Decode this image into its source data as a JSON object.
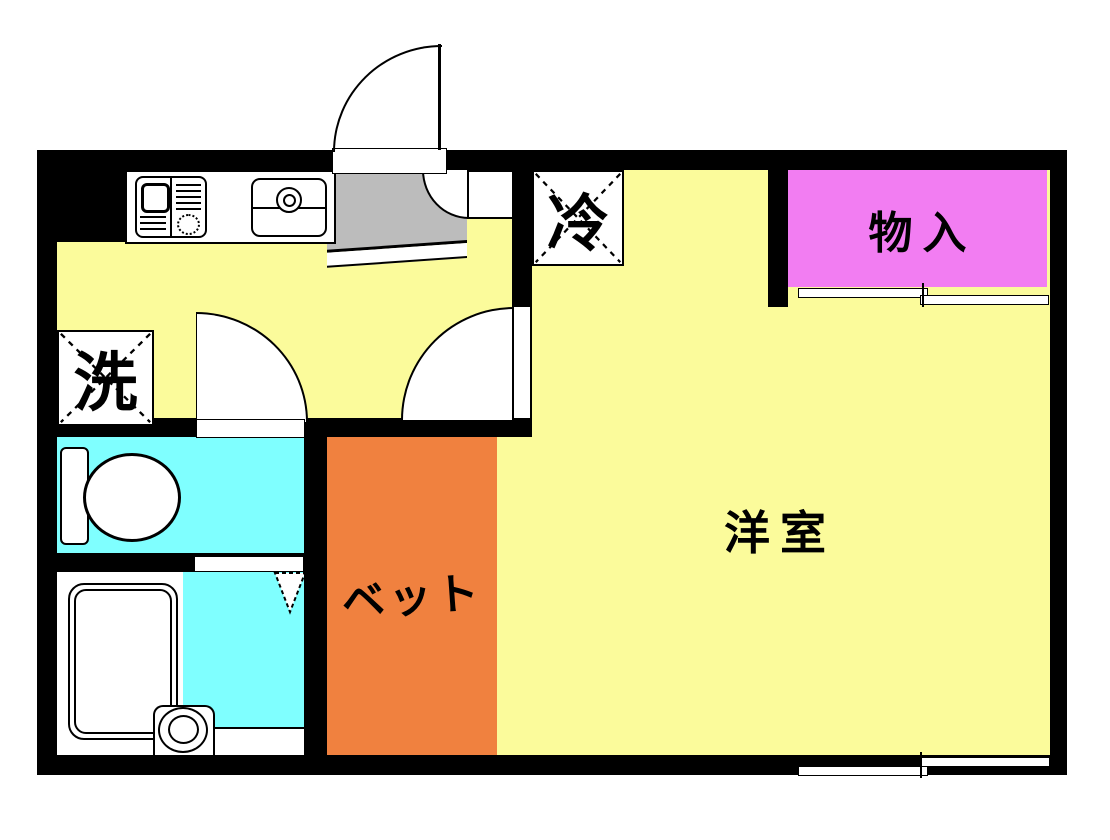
{
  "floorplan": {
    "title": "apartment-floor-plan",
    "rooms": {
      "western_room": {
        "label": "洋室",
        "color": "#FBFB9B"
      },
      "bed_space": {
        "label": "ベット",
        "color": "#F0813F"
      },
      "storage": {
        "label": "物入",
        "color": "#F27DF2"
      },
      "refrigerator_box": {
        "label": "冷"
      },
      "washer_box": {
        "label": "洗"
      },
      "toilet": {
        "color": "#7FFFFF"
      },
      "bathroom": {
        "color": "#7FFFFF"
      },
      "entry": {
        "color": "#BCBCBC"
      }
    },
    "wall_color": "#000000"
  }
}
